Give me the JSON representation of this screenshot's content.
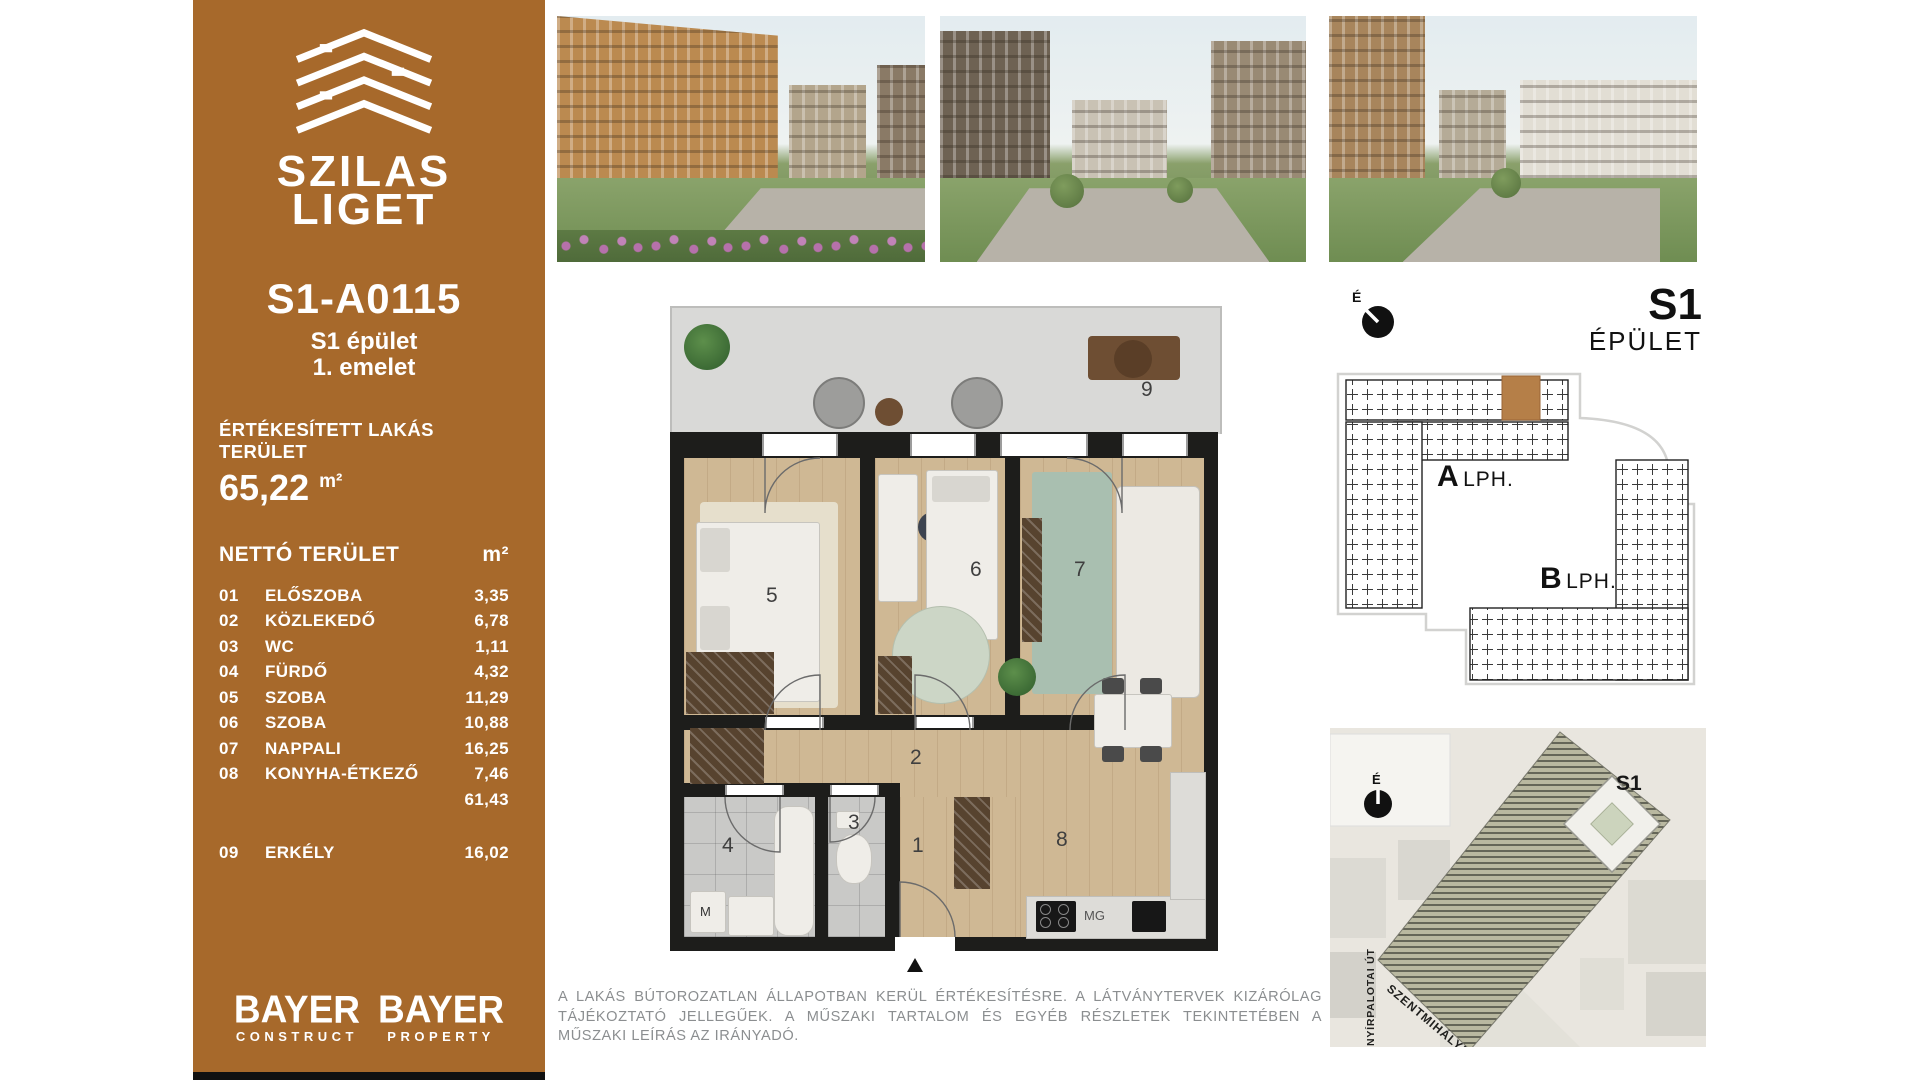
{
  "sidebar": {
    "brand_line1": "SZILAS",
    "brand_line2": "LIGET",
    "unit_id": "S1-A0115",
    "building": "S1 épület",
    "floor": "1. emelet",
    "sold_area_label": "ÉRTÉKESÍTETT LAKÁS TERÜLET",
    "sold_area_value": "65,22",
    "area_unit": "m²",
    "net_area_label": "NETTÓ TERÜLET",
    "rooms": [
      {
        "no": "01",
        "name": "ELŐSZOBA",
        "area": "3,35"
      },
      {
        "no": "02",
        "name": "KÖZLEKEDŐ",
        "area": "6,78"
      },
      {
        "no": "03",
        "name": "WC",
        "area": "1,11"
      },
      {
        "no": "04",
        "name": "FÜRDŐ",
        "area": "4,32"
      },
      {
        "no": "05",
        "name": "SZOBA",
        "area": "11,29"
      },
      {
        "no": "06",
        "name": "SZOBA",
        "area": "10,88"
      },
      {
        "no": "07",
        "name": "NAPPALI",
        "area": "16,25"
      },
      {
        "no": "08",
        "name": "KONYHA-ÉTKEZŐ",
        "area": "7,46"
      }
    ],
    "net_subtotal": "61,43",
    "extra_room": {
      "no": "09",
      "name": "ERKÉLY",
      "area": "16,02"
    },
    "logo_construct": {
      "top": "BAYER",
      "bottom": "CONSTRUCT"
    },
    "logo_property": {
      "top": "BAYER",
      "bottom": "PROPERTY"
    },
    "brand_color": "#A7692B"
  },
  "floorplan": {
    "numbers": {
      "n1": "1",
      "n2": "2",
      "n3": "3",
      "n4": "4",
      "n5": "5",
      "n6": "6",
      "n7": "7",
      "n8": "8",
      "n9": "9"
    },
    "labels": {
      "washer": "M",
      "stove": "MG"
    }
  },
  "building_panel": {
    "compass_label": "É",
    "title": "S1",
    "subtitle": "ÉPÜLET",
    "staircase_a": "A",
    "staircase_a_suffix": "LPH.",
    "staircase_b": "B",
    "staircase_b_suffix": "LPH.",
    "highlight_color": "#b57f48"
  },
  "map_panel": {
    "compass_label": "É",
    "building_label": "S1",
    "street_vertical": "NYÍRPALOTAI ÚT",
    "street_diagonal": "SZENTMIHÁLYI ÚT"
  },
  "disclaimer": "A LAKÁS BÚTOROZATLAN ÁLLAPOTBAN KERÜL ÉRTÉKESÍTÉSRE. A LÁTVÁNYTERVEK KIZÁRÓLAG TÁJÉKOZTATÓ JELLEGŰEK. A MŰSZAKI TARTALOM ÉS EGYÉB RÉSZLETEK TEKINTETÉBEN A MŰSZAKI LEÍRÁS AZ IRÁNYADÓ."
}
